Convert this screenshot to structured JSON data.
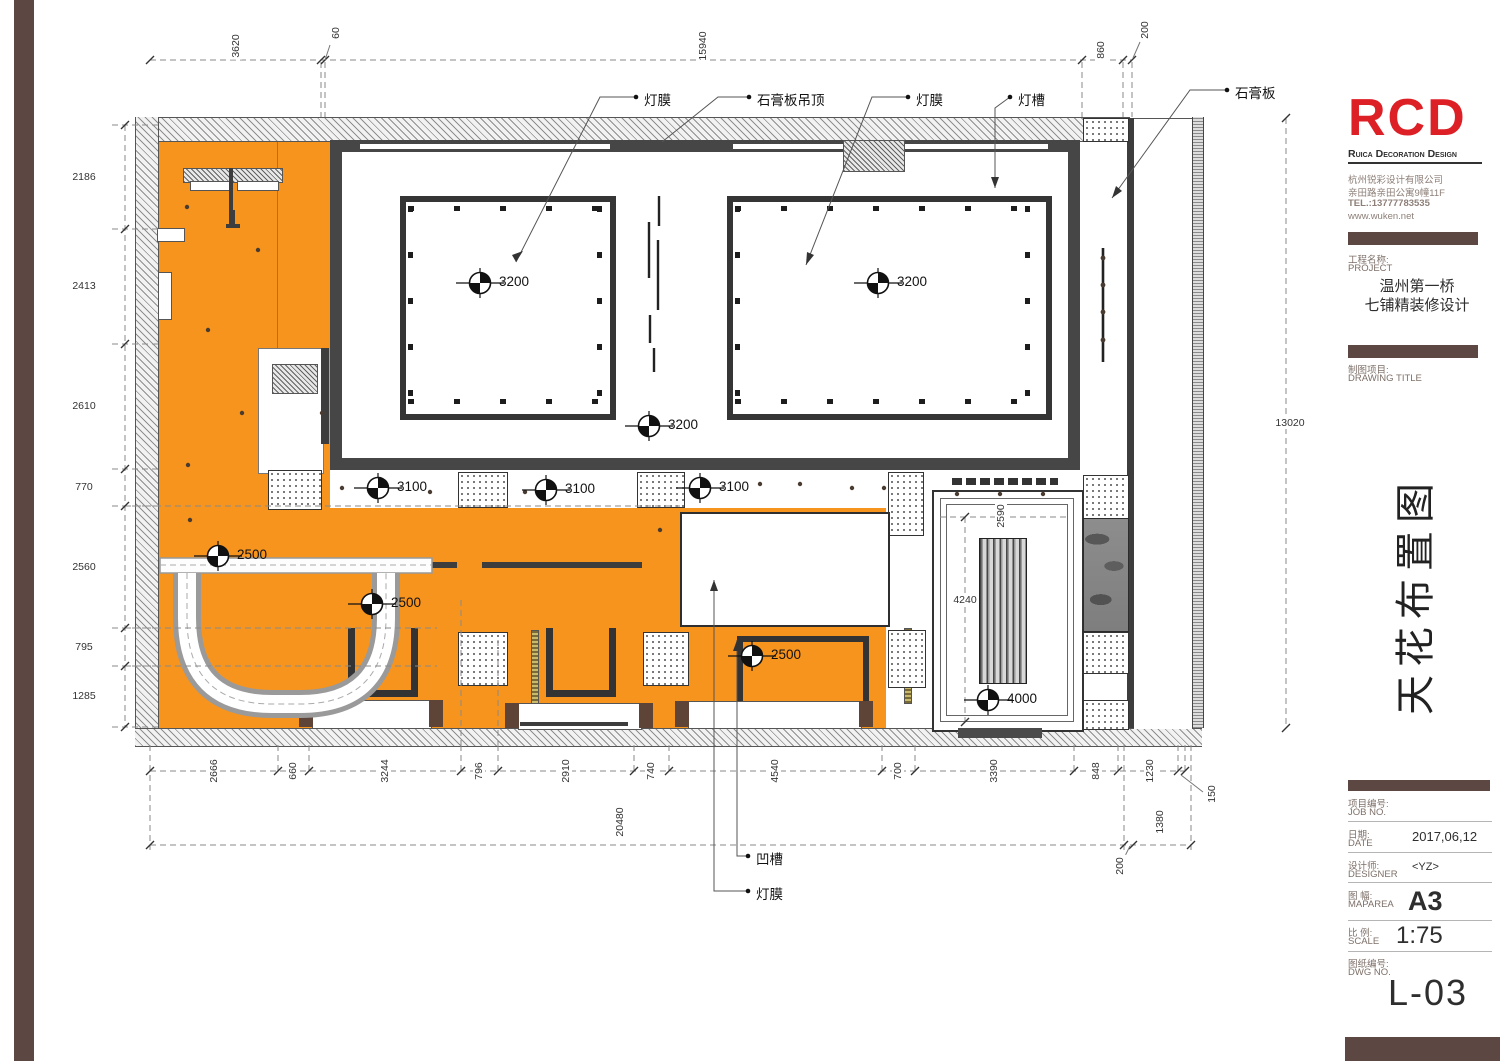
{
  "colors": {
    "orange": "#F7941E",
    "brown": "#5D4742",
    "logo_red": "#DD1F26",
    "frame_gray": "#464646"
  },
  "title_block": {
    "logo": "RCD",
    "logo_sub": "Ruica Decoration Design",
    "company": {
      "line1": "杭州锐彩设计有限公司",
      "line2": "亲田路亲田公寓9幢11F",
      "line3": "TEL.:13777783535",
      "line4": "www.wuken.net"
    },
    "project_label_cn": "工程名称:",
    "project_label_en": "PROJECT",
    "project_name1": "温州第一桥",
    "project_name2": "七铺精装修设计",
    "drawing_label_cn": "制图项目:",
    "drawing_label_en": "DRAWING TITLE",
    "drawing_title": "天花布置图",
    "job_cn": "项目编号:",
    "job_en": "JOB NO.",
    "job_value": "",
    "date_cn": "日期:",
    "date_en": "DATE",
    "date_value": "2017,06,12",
    "designer_cn": "设计师:",
    "designer_en": "DESIGNER",
    "designer_value": "<YZ>",
    "maparea_cn": "图 幅:",
    "maparea_en": "MAPAREA",
    "maparea_value": "A3",
    "scale_cn": "比 例:",
    "scale_en": "SCALE",
    "scale_value": "1:75",
    "dwg_cn": "图纸编号:",
    "dwg_en": "DWG NO.",
    "dwg_value": "L-03"
  },
  "plan": {
    "leaders": [
      "灯膜",
      "石膏板吊顶",
      "灯膜",
      "灯槽",
      "石膏板",
      "凹槽",
      "灯膜"
    ],
    "levels": [
      "3200",
      "3200",
      "3200",
      "3100",
      "3100",
      "3100",
      "2500",
      "2500",
      "2500",
      "4000"
    ],
    "dims": {
      "top": [
        "3620",
        "60",
        "15940",
        "860",
        "200"
      ],
      "left": [
        "2186",
        "2413",
        "2610",
        "770",
        "2560",
        "795",
        "1285"
      ],
      "right": [
        "13020"
      ],
      "bottom_row1": [
        "2666",
        "660",
        "3244",
        "796",
        "2910",
        "740",
        "4540",
        "700",
        "3390",
        "848",
        "1230",
        "150"
      ],
      "bottom_row2": [
        "20480",
        "1380",
        "200"
      ],
      "inner": [
        "2590",
        "4240"
      ]
    }
  }
}
